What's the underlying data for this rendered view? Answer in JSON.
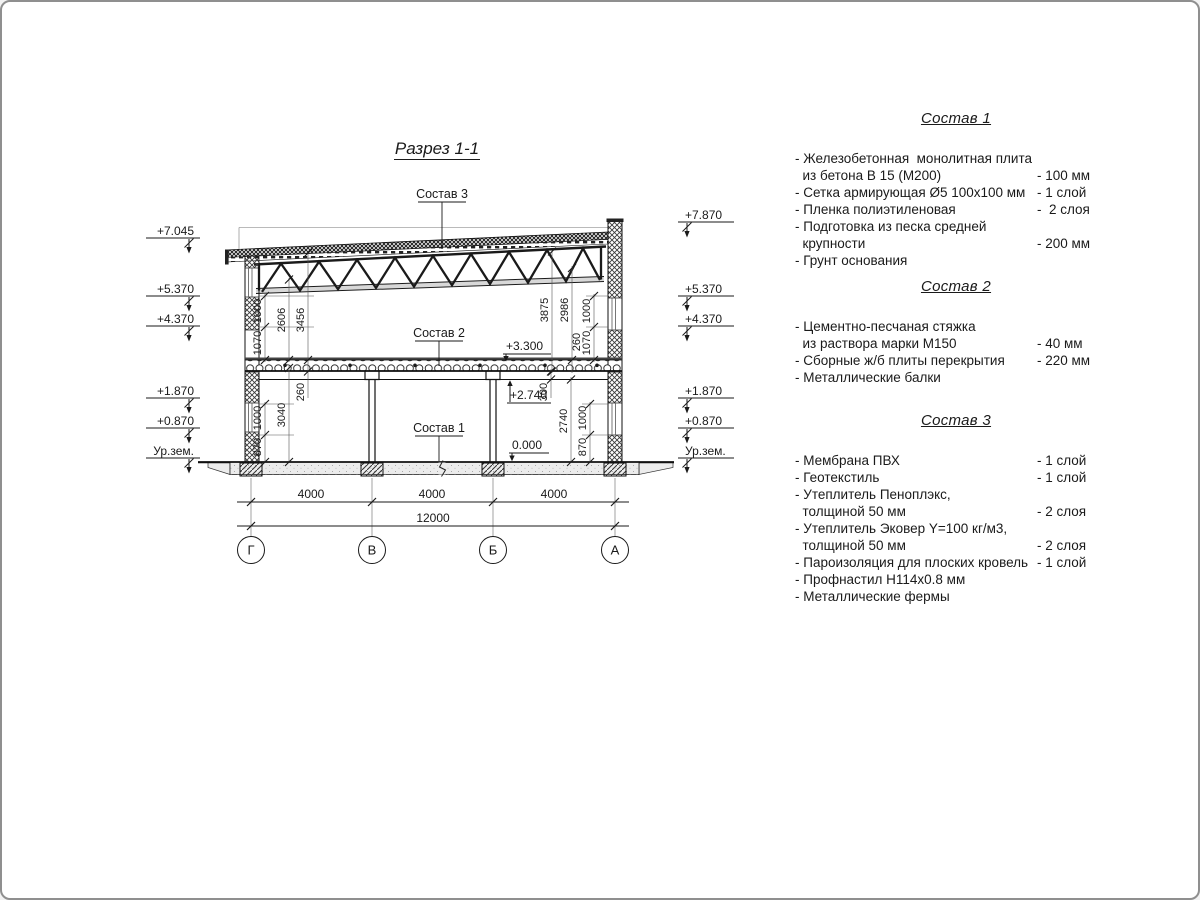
{
  "drawing": {
    "section_title": "Разрез 1-1",
    "labels": {
      "sostav1": "Состав 1",
      "sostav2": "Состав 2",
      "sostav3": "Состав 3",
      "lvl_slab_top": "+3.300",
      "lvl_beam_bottom": "+2.740",
      "lvl_zero": "0.000"
    },
    "elev_left": [
      "+7.045",
      "+5.370",
      "+4.370",
      "+1.870",
      "+0.870",
      "Ур.зем."
    ],
    "elev_right": [
      "+7.870",
      "+5.370",
      "+4.370",
      "+1.870",
      "+0.870",
      "Ур.зем."
    ],
    "dims_bottom": [
      "4000",
      "4000",
      "4000"
    ],
    "dim_total": "12000",
    "axes": [
      "Г",
      "В",
      "Б",
      "А"
    ],
    "vdims": {
      "upper_left": [
        "1070",
        "1000",
        "2606",
        "3456"
      ],
      "upper_right": [
        "3875",
        "2986",
        "260",
        "1070",
        "1000"
      ],
      "lower_left": [
        "870",
        "1000",
        "3040",
        "260"
      ],
      "lower_right": [
        "300",
        "2740",
        "870",
        "1000"
      ]
    }
  },
  "notes": [
    {
      "title": "Состав 1",
      "items": [
        {
          "name": "- Железобетонная  монолитная плита\n  из бетона В 15 (М200)",
          "value": "- 100 мм"
        },
        {
          "name": "- Сетка армирующая Ø5 100х100 мм",
          "value": "- 1 слой"
        },
        {
          "name": "- Пленка полиэтиленовая",
          "value": "-  2 слоя"
        },
        {
          "name": "- Подготовка из песка средней\n  крупности",
          "value": "- 200 мм"
        },
        {
          "name": "- Грунт основания",
          "value": ""
        }
      ]
    },
    {
      "title": "Состав 2",
      "items": [
        {
          "name": "- Цементно-песчаная стяжка\n  из раствора марки М150",
          "value": "- 40 мм"
        },
        {
          "name": "- Сборные ж/б плиты перекрытия",
          "value": "- 220 мм"
        },
        {
          "name": "- Металлические балки",
          "value": ""
        }
      ]
    },
    {
      "title": "Состав 3",
      "items": [
        {
          "name": "- Мембрана ПВХ",
          "value": "- 1 слой"
        },
        {
          "name": "- Геотекстиль",
          "value": "- 1 слой"
        },
        {
          "name": "- Утеплитель Пеноплэкс,\n  толщиной 50 мм",
          "value": "- 2 слоя"
        },
        {
          "name": "- Утеплитель Эковер Y=100 кг/м3,\n  толщиной 50 мм",
          "value": "- 2 слоя"
        },
        {
          "name": "- Пароизоляция для плоских кровель",
          "value": "- 1 слой"
        },
        {
          "name": "- Профнастил Н114х0.8 мм",
          "value": ""
        },
        {
          "name": "- Металлические фермы",
          "value": ""
        }
      ]
    }
  ]
}
